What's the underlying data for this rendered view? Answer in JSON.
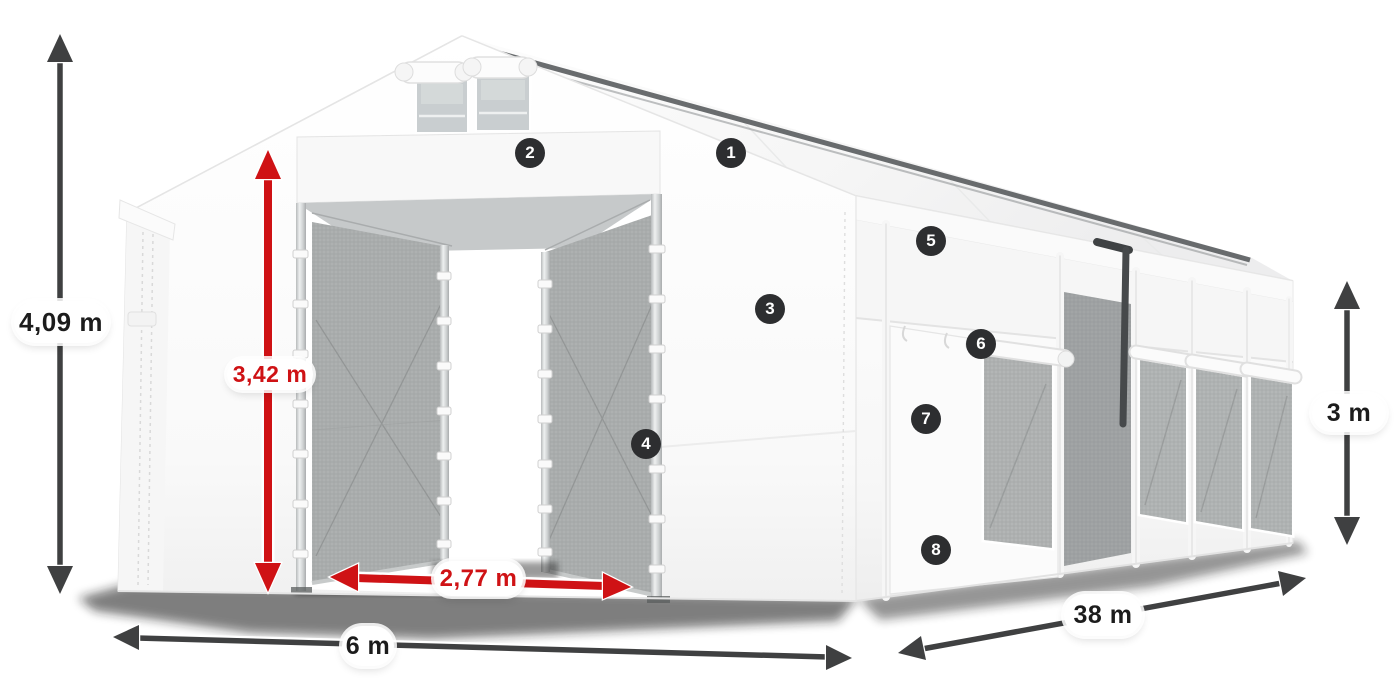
{
  "page": {
    "background": "#ffffff"
  },
  "product_diagram": {
    "type": "tent-dimension-diagram",
    "dimensions": {
      "total_height": {
        "label": "4,09 m",
        "style": "dark"
      },
      "entrance_height": {
        "label": "3,42 m",
        "style": "red"
      },
      "entrance_width": {
        "label": "2,77 m",
        "style": "red"
      },
      "width": {
        "label": "6 m",
        "style": "dark"
      },
      "length": {
        "label": "38 m",
        "style": "dark"
      },
      "side_height": {
        "label": "3 m",
        "style": "dark"
      }
    },
    "badges": [
      {
        "number": "1"
      },
      {
        "number": "2"
      },
      {
        "number": "3"
      },
      {
        "number": "4"
      },
      {
        "number": "5"
      },
      {
        "number": "6"
      },
      {
        "number": "7"
      },
      {
        "number": "8"
      }
    ],
    "colors": {
      "dimension_dark": "#3f4041",
      "dimension_red": "#cf1215",
      "badge_background": "#2d2e30",
      "badge_text": "#ffffff",
      "label_background": "#ffffff",
      "label_text_dark": "#1c1c1c"
    }
  }
}
